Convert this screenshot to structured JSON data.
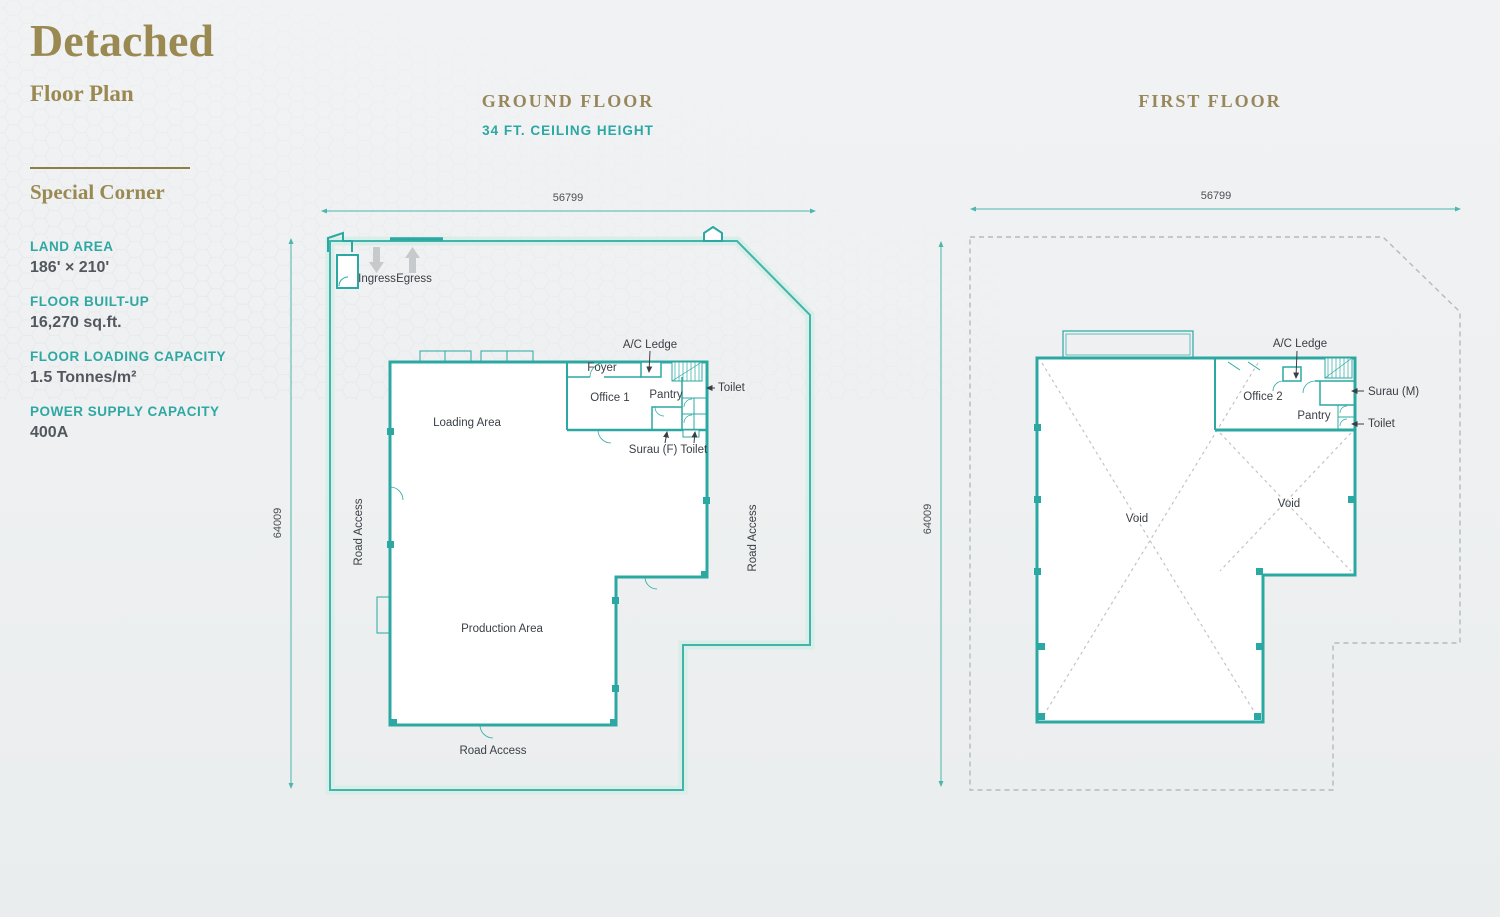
{
  "page": {
    "title": "Detached",
    "subtitle": "Floor Plan",
    "section_title": "Special Corner",
    "specs": [
      {
        "label": "LAND AREA",
        "value": "186' × 210'"
      },
      {
        "label": "FLOOR BUILT-UP",
        "value": "16,270 sq.ft."
      },
      {
        "label": "FLOOR LOADING CAPACITY",
        "value": "1.5 Tonnes/m²"
      },
      {
        "label": "POWER SUPPLY CAPACITY",
        "value": "400A"
      }
    ]
  },
  "ground_floor": {
    "heading": "GROUND FLOOR",
    "subheading": "34 FT. CEILING HEIGHT",
    "dim_width": "56799",
    "dim_height": "64009",
    "labels": {
      "ingress": "Ingress",
      "egress": "Egress",
      "ac_ledge": "A/C Ledge",
      "foyer": "Foyer",
      "office": "Office 1",
      "pantry": "Pantry",
      "toilet": "Toilet",
      "surau_toilet": "Surau (F) Toilet",
      "loading": "Loading Area",
      "production": "Production Area",
      "road_left": "Road Access",
      "road_right": "Road Access",
      "road_bottom": "Road Access"
    }
  },
  "first_floor": {
    "heading": "FIRST FLOOR",
    "dim_width": "56799",
    "dim_height": "64009",
    "labels": {
      "ac_ledge": "A/C Ledge",
      "office": "Office 2",
      "surau": "Surau (M)",
      "pantry": "Pantry",
      "toilet": "Toilet",
      "void_left": "Void",
      "void_right": "Void"
    }
  },
  "colors": {
    "gold": "#9a8a52",
    "teal_text": "#2fa8a2",
    "plan_teal": "#2ba8a1",
    "plan_band": "#d8eee8",
    "text_dark": "#53575e",
    "dashed_gray": "#b4babd"
  }
}
